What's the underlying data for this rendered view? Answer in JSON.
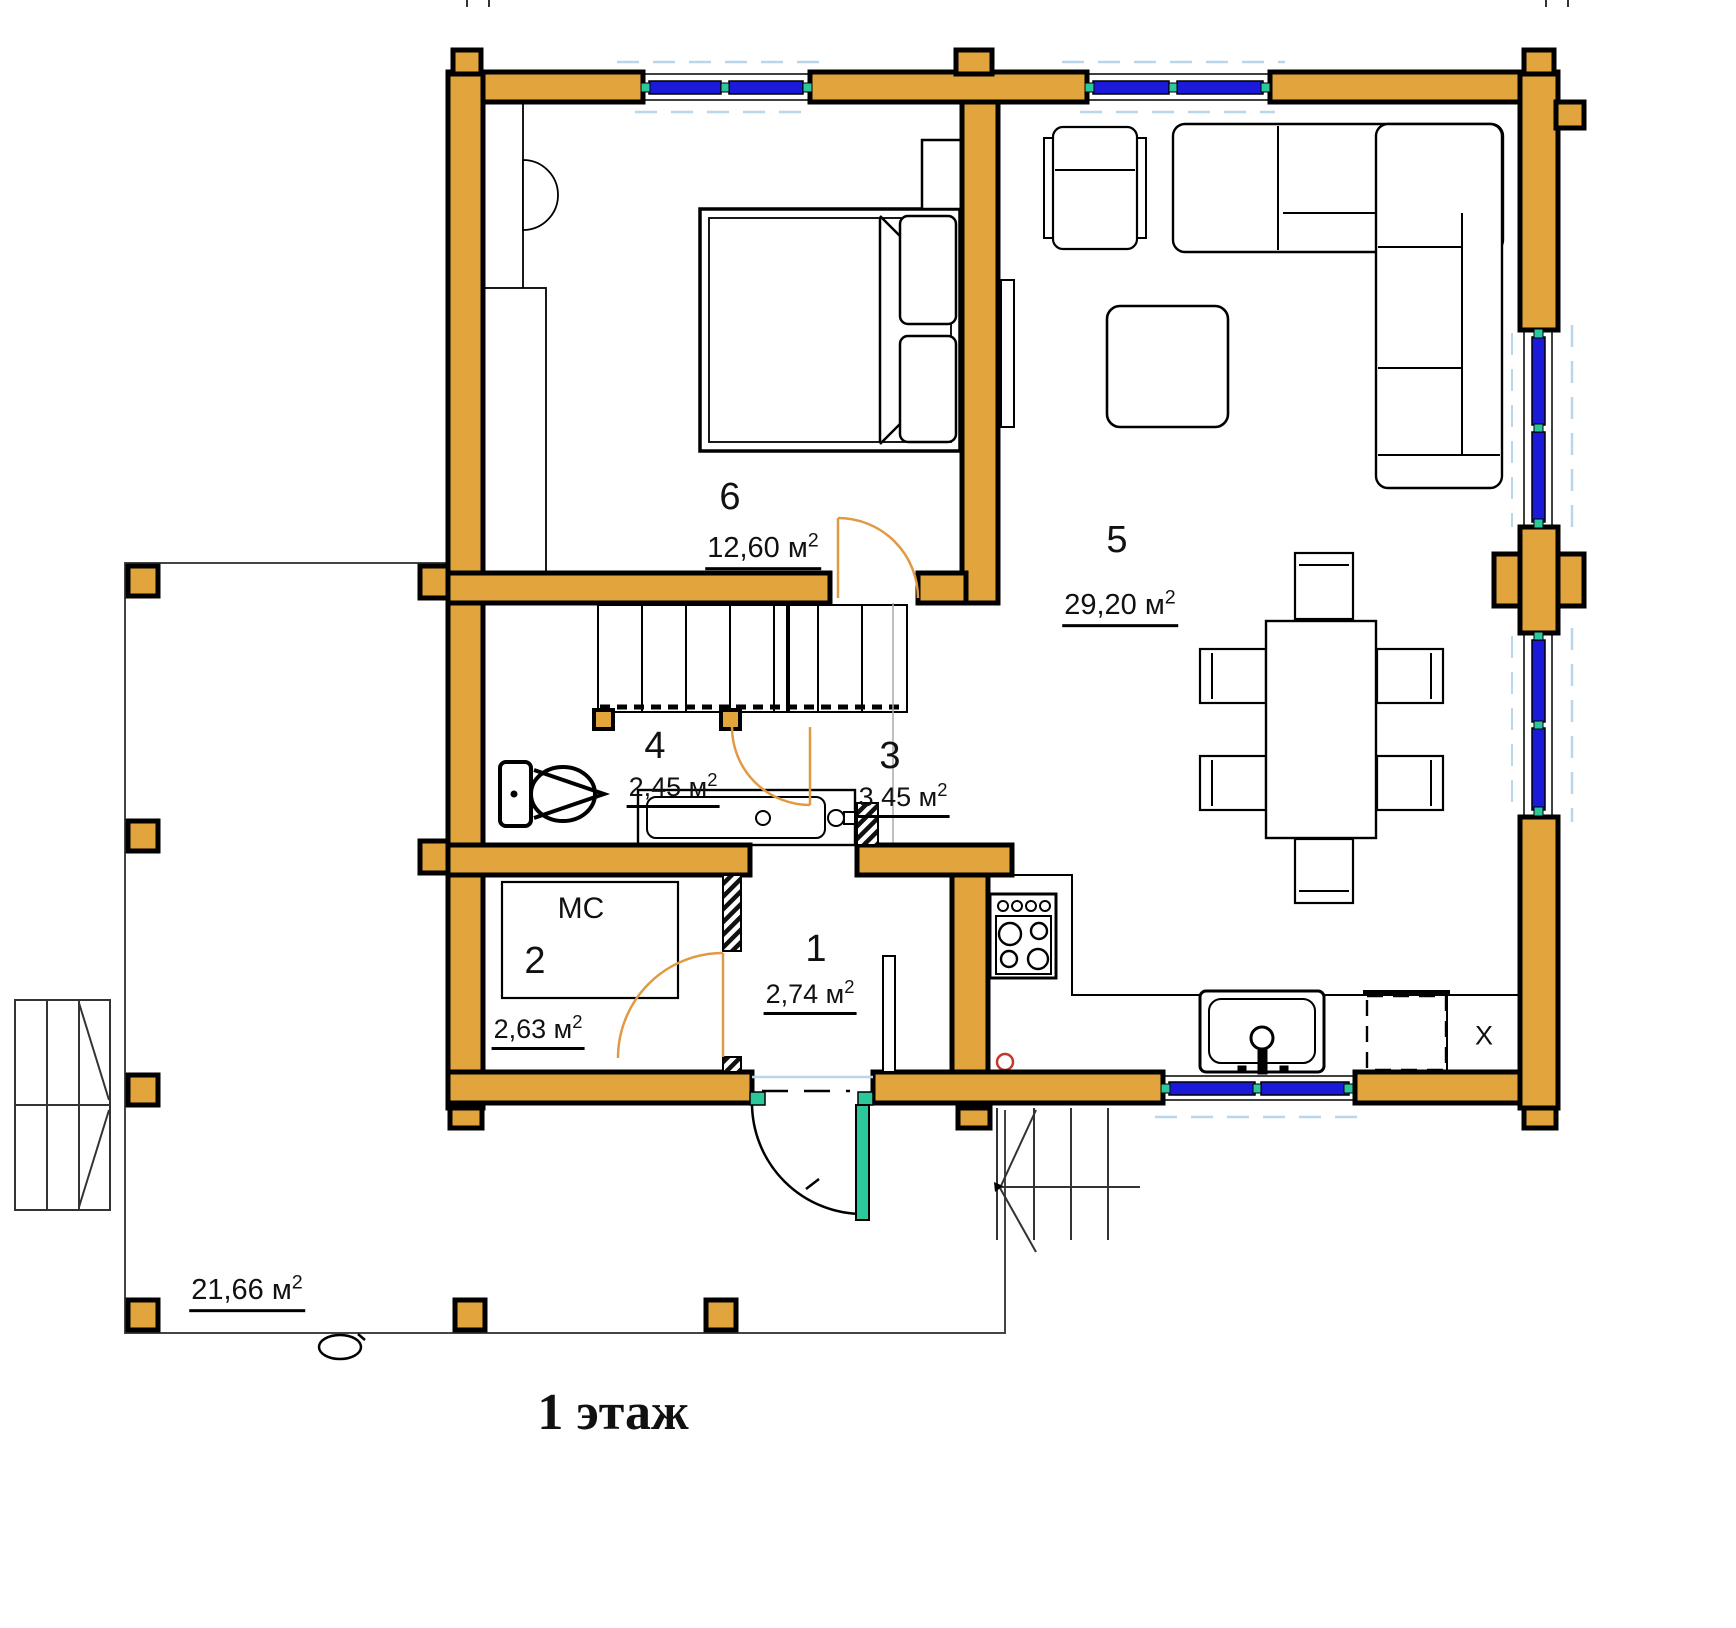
{
  "title": "1 этаж",
  "rooms": [
    {
      "num": "1",
      "area": "2,74 м",
      "sup": "2"
    },
    {
      "num": "2",
      "area": "2,63 м",
      "sup": "2"
    },
    {
      "num": "3",
      "area": "3,45 м",
      "sup": "2"
    },
    {
      "num": "4",
      "area": "2,45 м",
      "sup": "2"
    },
    {
      "num": "5",
      "area": "29,20 м",
      "sup": "2"
    },
    {
      "num": "6",
      "area": "12,60 м",
      "sup": "2"
    }
  ],
  "terrace": {
    "area": "21,66 м",
    "sup": "2"
  },
  "appliances": {
    "washing_machine": "МС",
    "fridge": "X"
  },
  "colors": {
    "log_wall": "#E2A43C",
    "window_glass": "#1A1AD8",
    "frame_accent": "#2BC89C",
    "door_swing": "#E09A45",
    "marker_red": "#C0392B"
  }
}
